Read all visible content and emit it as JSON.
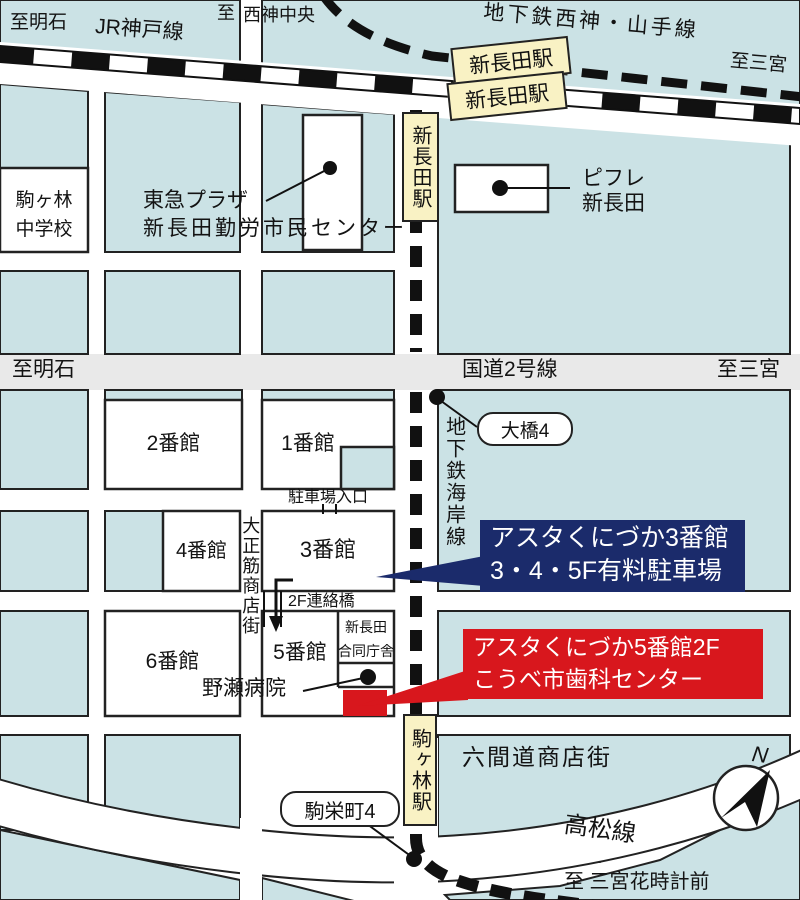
{
  "colors": {
    "block_teal": "#cbe2e5",
    "road_white": "#ffffff",
    "route2_gray": "#e9e9e9",
    "station_yellow": "#f9f2c4",
    "callout_navy": "#1b2b6b",
    "callout_red": "#d8171d",
    "line_black": "#111111"
  },
  "top": {
    "to_akashi": "至明石",
    "jr_line": "JR神戸線",
    "to_prefix": "至",
    "seishin_chuo": "西神中央",
    "subway_line": "地下鉄西神・山手線",
    "to_sannomiya": "至三宮",
    "station_box1": "新長田駅",
    "station_box2": "新長田駅",
    "station_strip": "新長田駅"
  },
  "left": {
    "school_line1": "駒ヶ林",
    "school_line2": "中学校",
    "tokyu_line1": "東急プラザ",
    "tokyu_line2": "新長田勤労市民センター"
  },
  "piffle": {
    "line1": "ピフレ",
    "line2": "新長田"
  },
  "route2": {
    "to_akashi": "至明石",
    "name": "国道2号線",
    "to_sannomiya": "至三宮"
  },
  "kaigan_line": "地下鉄海岸線",
  "ohashi4": "大橋4",
  "blocks": {
    "b2": "2番館",
    "b1": "1番館",
    "b4": "4番館",
    "b3": "3番館",
    "b6": "6番館",
    "b5": "5番館",
    "godo_line1": "新長田",
    "godo_line2": "合同庁舎"
  },
  "labels": {
    "parking_entrance": "駐車場入口",
    "bridge": "2F連絡橋",
    "taisho": "大正筋商店街",
    "nose_hospital": "野瀬病院",
    "rokkenmichi": "六間道商店街",
    "takamatsu": "高松線",
    "komagabayashi_strip": "駒ヶ林駅",
    "komaeicho4": "駒栄町4",
    "compass_n": "N"
  },
  "callout_parking": {
    "line1": "アスタくにづか3番館",
    "line2": "3・4・5F有料駐車場"
  },
  "callout_dental": {
    "line1": "アスタくにづか5番館2F",
    "line2": "こうべ市歯科センター"
  },
  "bottom": {
    "to_hanadokei": "至 三宮花時計前"
  }
}
